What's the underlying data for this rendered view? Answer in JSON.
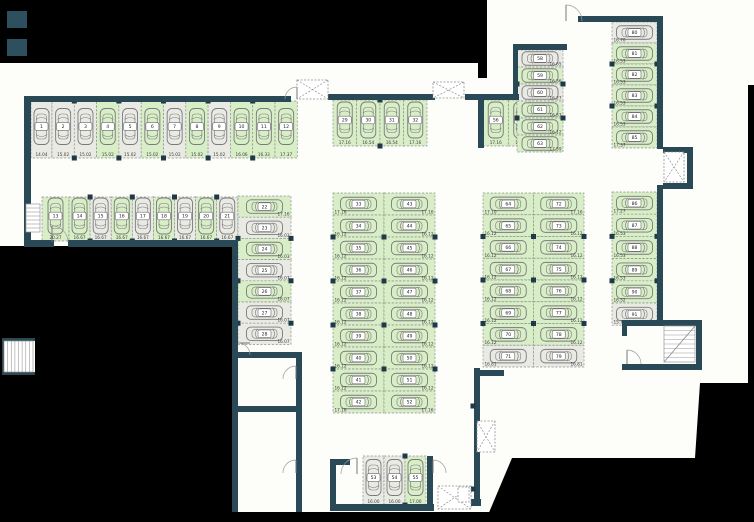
{
  "title": "parking-garage-floor-plan",
  "colors": {
    "wall": "#2a4956",
    "stall_green": "#d8eec7",
    "stall_gray": "#eaeae5",
    "stall_border": "#8f8f8f",
    "car": "#7a7a7a",
    "number_text": "#222222",
    "dim_text": "#3a3a3a",
    "outside": "#000000",
    "background": "#fdfdfa",
    "node": "#1f3946",
    "accent": "#2e505e",
    "door": "#9a9a9a",
    "shaft": "#909090"
  },
  "groups": [
    {
      "name": "row-1",
      "orientation": "v",
      "x": 31,
      "y": 101,
      "h": 57,
      "stall_w": 22.3,
      "first_w": 21,
      "label": "bottom",
      "stalls": [
        {
          "n": "1",
          "dim": "14.04",
          "c": "gray"
        },
        {
          "n": "2",
          "dim": "15.02",
          "c": "gray"
        },
        {
          "n": "3",
          "dim": "15.02",
          "c": "gray"
        },
        {
          "n": "4",
          "dim": "15.02",
          "c": "green"
        },
        {
          "n": "5",
          "dim": "15.02",
          "c": "gray"
        },
        {
          "n": "6",
          "dim": "15.02",
          "c": "green"
        },
        {
          "n": "7",
          "dim": "15.02",
          "c": "gray"
        },
        {
          "n": "8",
          "dim": "15.02",
          "c": "green"
        },
        {
          "n": "9",
          "dim": "15.02",
          "c": "gray"
        },
        {
          "n": "10",
          "dim": "16.06",
          "c": "green"
        },
        {
          "n": "11",
          "dim": "16.33",
          "c": "green"
        },
        {
          "n": "12",
          "dim": "17.37",
          "c": "green"
        }
      ]
    },
    {
      "name": "row-2",
      "orientation": "v",
      "x": 42,
      "y": 197,
      "h": 44,
      "stall_w": 21.1,
      "first_w": 27,
      "label": "bottom",
      "stalls": [
        {
          "n": "13",
          "dim": "20.27",
          "c": "green"
        },
        {
          "n": "14",
          "dim": "16.67",
          "c": "green"
        },
        {
          "n": "15",
          "dim": "16.67",
          "c": "gray"
        },
        {
          "n": "16",
          "dim": "16.67",
          "c": "green"
        },
        {
          "n": "17",
          "dim": "16.67",
          "c": "gray"
        },
        {
          "n": "18",
          "dim": "16.67",
          "c": "green"
        },
        {
          "n": "19",
          "dim": "16.67",
          "c": "gray"
        },
        {
          "n": "20",
          "dim": "16.67",
          "c": "green"
        },
        {
          "n": "21",
          "dim": "16.67",
          "c": "gray"
        }
      ]
    },
    {
      "name": "col-22",
      "orientation": "h",
      "x": 238,
      "y": 196,
      "w": 53,
      "stall_h": 21.2,
      "label": "right",
      "stalls": [
        {
          "n": "22",
          "dim": "17.16",
          "c": "green"
        },
        {
          "n": "23",
          "dim": "16.03",
          "c": "gray"
        },
        {
          "n": "24",
          "dim": "16.03",
          "c": "green"
        },
        {
          "n": "25",
          "dim": "16.07",
          "c": "gray"
        },
        {
          "n": "26",
          "dim": "16.07",
          "c": "green"
        },
        {
          "n": "27",
          "dim": "16.07",
          "c": "gray"
        },
        {
          "n": "28",
          "dim": "16.07",
          "c": "gray"
        }
      ]
    },
    {
      "name": "row-29",
      "orientation": "v",
      "x": 333,
      "y": 100,
      "h": 46,
      "stall_w": 23.5,
      "label": "bottom",
      "stalls": [
        {
          "n": "29",
          "dim": "17.16",
          "c": "green"
        },
        {
          "n": "30",
          "dim": "16.54",
          "c": "green"
        },
        {
          "n": "31",
          "dim": "16.54",
          "c": "green"
        },
        {
          "n": "32",
          "dim": "17.16",
          "c": "green"
        }
      ]
    },
    {
      "name": "col-33",
      "orientation": "h",
      "x": 333,
      "y": 193,
      "w": 51,
      "stall_h": 22,
      "label": "left",
      "stalls": [
        {
          "n": "33",
          "dim": "17.16",
          "c": "green"
        },
        {
          "n": "34",
          "dim": "16.12",
          "c": "green"
        },
        {
          "n": "35",
          "dim": "16.12",
          "c": "green"
        },
        {
          "n": "36",
          "dim": "16.12",
          "c": "green"
        },
        {
          "n": "37",
          "dim": "16.12",
          "c": "green"
        },
        {
          "n": "38",
          "dim": "16.12",
          "c": "green"
        },
        {
          "n": "39",
          "dim": "16.12",
          "c": "green"
        },
        {
          "n": "40",
          "dim": "16.12",
          "c": "green"
        },
        {
          "n": "41",
          "dim": "16.12",
          "c": "green"
        },
        {
          "n": "42",
          "dim": "17.16",
          "c": "green"
        }
      ]
    },
    {
      "name": "col-43",
      "orientation": "h",
      "x": 384,
      "y": 193,
      "w": 51,
      "stall_h": 22,
      "label": "right",
      "stalls": [
        {
          "n": "43",
          "dim": "17.16",
          "c": "green"
        },
        {
          "n": "44",
          "dim": "16.12",
          "c": "green"
        },
        {
          "n": "45",
          "dim": "16.12",
          "c": "green"
        },
        {
          "n": "46",
          "dim": "16.12",
          "c": "green"
        },
        {
          "n": "47",
          "dim": "16.12",
          "c": "green"
        },
        {
          "n": "48",
          "dim": "16.12",
          "c": "green"
        },
        {
          "n": "49",
          "dim": "16.12",
          "c": "green"
        },
        {
          "n": "50",
          "dim": "16.12",
          "c": "green"
        },
        {
          "n": "51",
          "dim": "16.12",
          "c": "green"
        },
        {
          "n": "52",
          "dim": "17.16",
          "c": "green"
        }
      ]
    },
    {
      "name": "row-53",
      "orientation": "v",
      "x": 363,
      "y": 456,
      "h": 49,
      "stall_w": 21,
      "label": "bottom",
      "stalls": [
        {
          "n": "53",
          "dim": "16.00",
          "c": "gray"
        },
        {
          "n": "54",
          "dim": "16.00",
          "c": "gray"
        },
        {
          "n": "55",
          "dim": "17.00",
          "c": "green"
        }
      ]
    },
    {
      "name": "row-56",
      "orientation": "v",
      "x": 483,
      "y": 100,
      "h": 46,
      "stall_w": 25.5,
      "label": "bottom",
      "stalls": [
        {
          "n": "56",
          "dim": "17.16",
          "c": "green"
        },
        {
          "n": "57",
          "dim": "16.54",
          "c": "green"
        }
      ]
    },
    {
      "name": "col-58",
      "orientation": "h",
      "x": 517,
      "y": 50,
      "w": 46,
      "stall_h": 17,
      "label": "right",
      "stalls": [
        {
          "n": "58",
          "dim": "16.65",
          "c": "gray"
        },
        {
          "n": "59",
          "dim": "16.56",
          "c": "green"
        },
        {
          "n": "60",
          "dim": "16.27",
          "c": "gray"
        },
        {
          "n": "61",
          "dim": "16.53",
          "c": "green"
        },
        {
          "n": "62",
          "dim": "16.12",
          "c": "green"
        },
        {
          "n": "63",
          "dim": "17.59",
          "c": "green"
        }
      ]
    },
    {
      "name": "col-64",
      "orientation": "h",
      "x": 483,
      "y": 193,
      "w": 50.5,
      "stall_h": 21.75,
      "label": "left",
      "stalls": [
        {
          "n": "64",
          "dim": "17.10",
          "c": "green"
        },
        {
          "n": "65",
          "dim": "16.12",
          "c": "green"
        },
        {
          "n": "66",
          "dim": "16.12",
          "c": "green"
        },
        {
          "n": "67",
          "dim": "16.12",
          "c": "green"
        },
        {
          "n": "68",
          "dim": "16.12",
          "c": "green"
        },
        {
          "n": "69",
          "dim": "16.12",
          "c": "green"
        },
        {
          "n": "70",
          "dim": "16.12",
          "c": "green"
        },
        {
          "n": "71",
          "dim": "16.81",
          "c": "gray"
        }
      ]
    },
    {
      "name": "col-72",
      "orientation": "h",
      "x": 533.5,
      "y": 193,
      "w": 50.5,
      "stall_h": 21.75,
      "label": "right",
      "stalls": [
        {
          "n": "72",
          "dim": "17.16",
          "c": "green"
        },
        {
          "n": "73",
          "dim": "16.12",
          "c": "green"
        },
        {
          "n": "74",
          "dim": "16.12",
          "c": "green"
        },
        {
          "n": "75",
          "dim": "16.12",
          "c": "green"
        },
        {
          "n": "76",
          "dim": "16.12",
          "c": "green"
        },
        {
          "n": "77",
          "dim": "16.12",
          "c": "green"
        },
        {
          "n": "78",
          "dim": "16.12",
          "c": "green"
        },
        {
          "n": "79",
          "dim": "16.81",
          "c": "gray"
        }
      ]
    },
    {
      "name": "col-80",
      "orientation": "h",
      "x": 612,
      "y": 22,
      "w": 45,
      "stall_h": 21,
      "label": "left",
      "stalls": [
        {
          "n": "80",
          "dim": "16.70",
          "c": "gray"
        },
        {
          "n": "81",
          "dim": "16.53",
          "c": "green"
        },
        {
          "n": "82",
          "dim": "16.53",
          "c": "green"
        },
        {
          "n": "83",
          "dim": "16.53",
          "c": "green"
        },
        {
          "n": "84",
          "dim": "16.53",
          "c": "green"
        },
        {
          "n": "85",
          "dim": "17.37",
          "c": "green"
        }
      ]
    },
    {
      "name": "col-86",
      "orientation": "h",
      "x": 612,
      "y": 192,
      "w": 45,
      "stall_h": 22.2,
      "label": "left",
      "stalls": [
        {
          "n": "86",
          "dim": "17.27",
          "c": "green"
        },
        {
          "n": "87",
          "dim": "16.53",
          "c": "green"
        },
        {
          "n": "88",
          "dim": "16.53",
          "c": "green"
        },
        {
          "n": "89",
          "dim": "16.53",
          "c": "green"
        },
        {
          "n": "90",
          "dim": "16.52",
          "c": "green"
        },
        {
          "n": "91",
          "dim": "15.76",
          "c": "gray"
        }
      ]
    }
  ]
}
